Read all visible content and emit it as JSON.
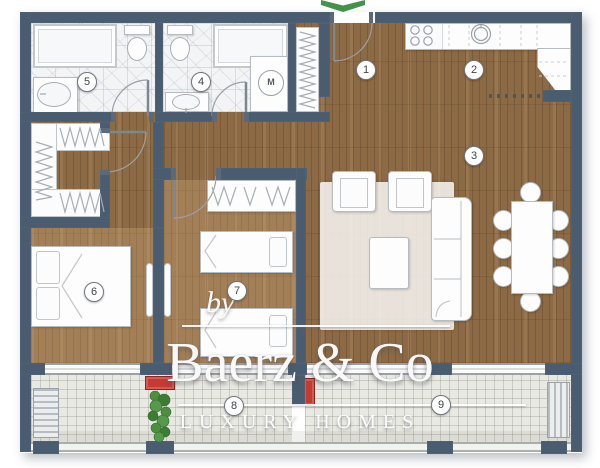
{
  "watermark": {
    "prefix": "by",
    "brand": "Baerz & Co",
    "tagline": "LUXURY HOMES"
  },
  "rooms": [
    {
      "number": "1"
    },
    {
      "number": "2"
    },
    {
      "number": "3"
    },
    {
      "number": "4"
    },
    {
      "number": "5"
    },
    {
      "number": "6"
    },
    {
      "number": "7"
    },
    {
      "number": "8"
    },
    {
      "number": "9"
    }
  ],
  "appliance_labels": {
    "washing_machine": "M"
  },
  "colors": {
    "wall": "#4a5c70",
    "wood_floor": "#8c6a45",
    "bedroom_floor_tint": "#eec694",
    "bathroom_floor": "#f3f4f6",
    "balcony_tile": "#e9e9e4",
    "accent_red": "#c63a31",
    "plant_green": "#4d8c42",
    "entrance_arrow_green": "#44934a",
    "watermark_white": "#ffffff"
  }
}
